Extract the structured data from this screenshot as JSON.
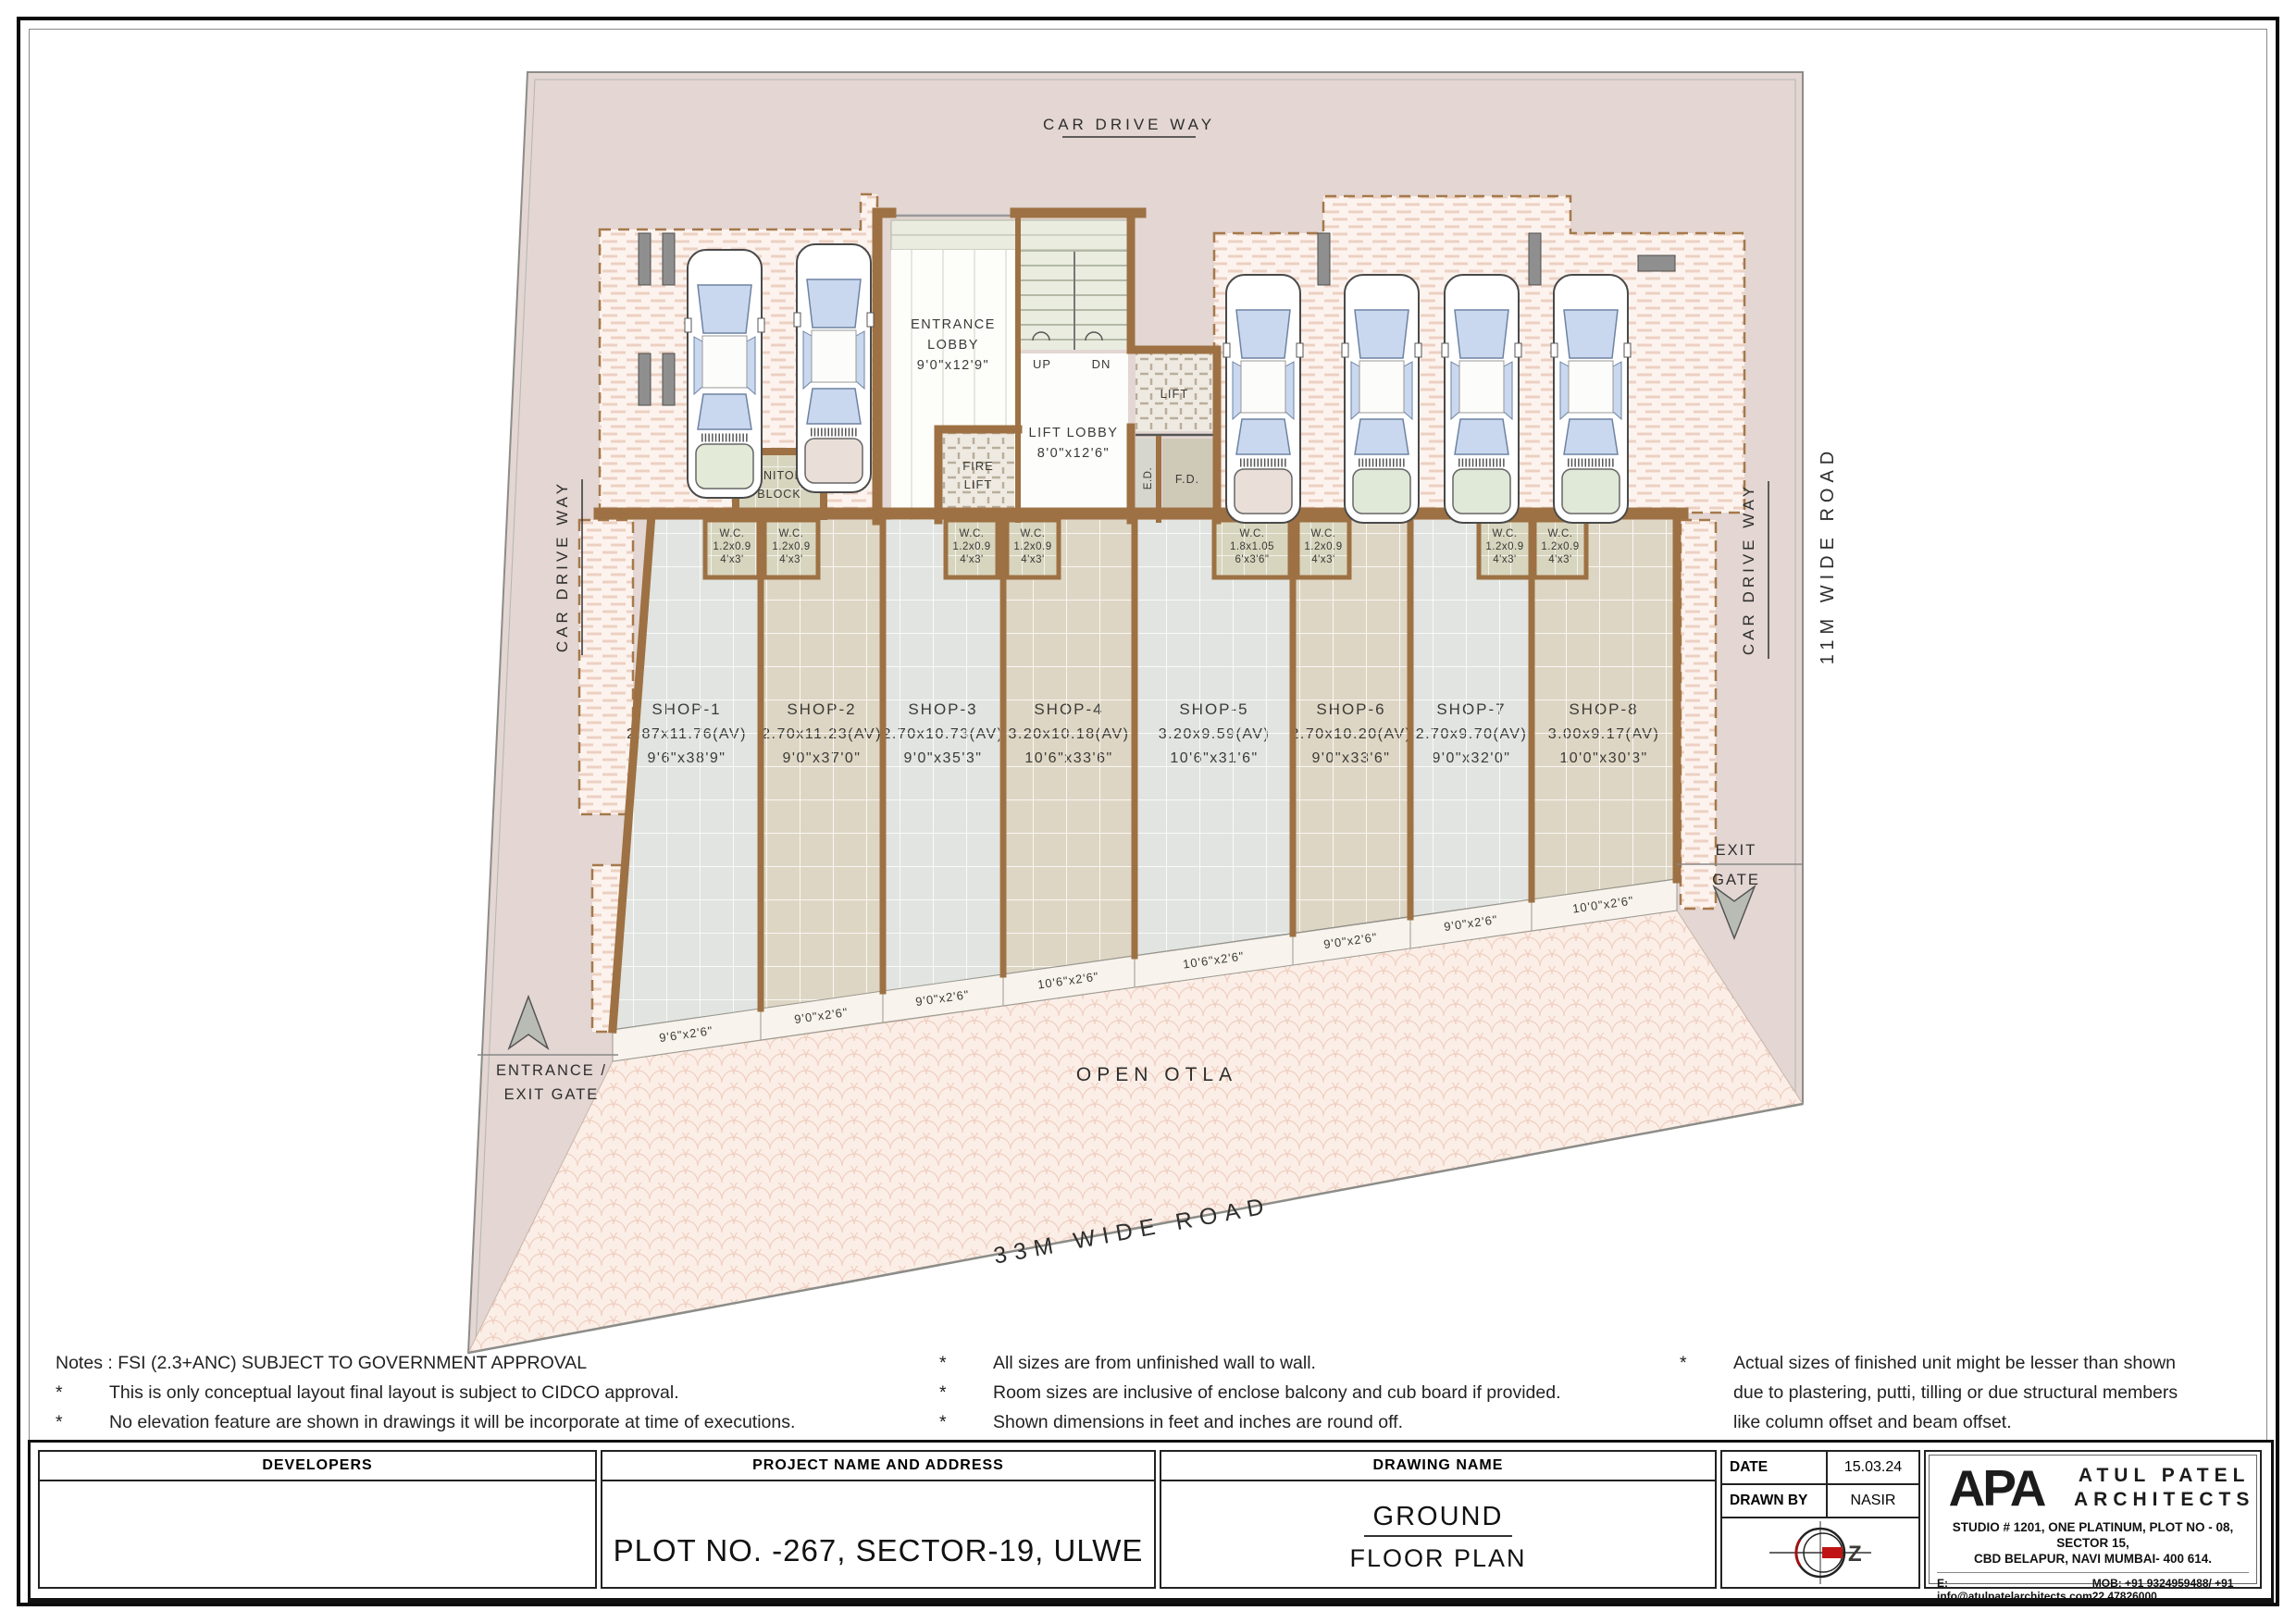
{
  "roads": {
    "top": "CAR DRIVE WAY",
    "left": "CAR DRIVE WAY",
    "right_inner": "CAR DRIVE WAY",
    "right": "11M WIDE ROAD",
    "bottom": "33M WIDE ROAD"
  },
  "areas": {
    "open_otla": "OPEN OTLA"
  },
  "gates": {
    "entrance_line1": "ENTRANCE /",
    "entrance_line2": "EXIT GATE",
    "exit_line1": "EXIT",
    "exit_line2": "GATE"
  },
  "rooms": {
    "entrance_lobby_1": "ENTRANCE",
    "entrance_lobby_2": "LOBBY",
    "entrance_lobby_dim": "9'0\"x12'9\"",
    "lift_lobby": "LIFT LOBBY",
    "lift_lobby_dim": "8'0\"x12'6\"",
    "lift": "LIFT",
    "fire_lift_1": "FIRE",
    "fire_lift_2": "LIFT",
    "sanitory_1": "SANITORY",
    "sanitory_2": "BLOCK",
    "ed": "E.D.",
    "fd": "F.D.",
    "up": "UP",
    "dn": "DN"
  },
  "wcs": [
    {
      "t": "W.C.",
      "m": "1.2x0.9",
      "f": "4'x3'"
    },
    {
      "t": "W.C.",
      "m": "1.2x0.9",
      "f": "4'x3'"
    },
    {
      "t": "W.C.",
      "m": "1.2x0.9",
      "f": "4'x3'"
    },
    {
      "t": "W.C.",
      "m": "1.2x0.9",
      "f": "4'x3'"
    },
    {
      "t": "W.C.",
      "m": "1.8x1.05",
      "f": "6'x3'6\""
    },
    {
      "t": "W.C.",
      "m": "1.2x0.9",
      "f": "4'x3'"
    },
    {
      "t": "W.C.",
      "m": "1.2x0.9",
      "f": "4'x3'"
    },
    {
      "t": "W.C.",
      "m": "1.2x0.9",
      "f": "4'x3'"
    }
  ],
  "shops": [
    {
      "name": "SHOP-1",
      "m": "2.87x11.76(AV)",
      "f": "9'6\"x38'9\""
    },
    {
      "name": "SHOP-2",
      "m": "2.70x11.23(AV)",
      "f": "9'0\"x37'0\""
    },
    {
      "name": "SHOP-3",
      "m": "2.70x10.73(AV)",
      "f": "9'0\"x35'3\""
    },
    {
      "name": "SHOP-4",
      "m": "3.20x10.18(AV)",
      "f": "10'6\"x33'6\""
    },
    {
      "name": "SHOP-5",
      "m": "3.20x9.59(AV)",
      "f": "10'6\"x31'6\""
    },
    {
      "name": "SHOP-6",
      "m": "2.70x10.20(AV)",
      "f": "9'0\"x33'6\""
    },
    {
      "name": "SHOP-7",
      "m": "2.70x9.70(AV)",
      "f": "9'0\"x32'0\""
    },
    {
      "name": "SHOP-8",
      "m": "3.00x9.17(AV)",
      "f": "10'0\"x30'3\""
    }
  ],
  "porches": [
    "9'6\"x2'6\"",
    "9'0\"x2'6\"",
    "9'0\"x2'6\"",
    "10'6\"x2'6\"",
    "10'6\"x2'6\"",
    "9'0\"x2'6\"",
    "9'0\"x2'6\"",
    "10'0\"x2'6\""
  ],
  "notes": {
    "star": "*",
    "c1_title": "Notes : FSI (2.3+ANC) SUBJECT TO GOVERNMENT APPROVAL",
    "c1": [
      "This is only conceptual layout final layout is subject to CIDCO approval.",
      "No elevation feature are shown in drawings it will be incorporate at time of executions."
    ],
    "c2": [
      "All sizes are from unfinished wall to wall.",
      "Room sizes are inclusive of enclose balcony and cub board if provided.",
      "Shown dimensions in feet and inches are round off."
    ],
    "c3_first": "Actual sizes of finished unit might be lesser than shown",
    "c3_rest": [
      "due to plastering, putti, tilling  or due structural members",
      "like column offset and beam offset."
    ]
  },
  "titleblock": {
    "developers_header": "DEVELOPERS",
    "project_header": "PROJECT NAME AND ADDRESS",
    "project_value": "PLOT NO. -267, SECTOR-19, ULWE",
    "drawing_header": "DRAWING NAME",
    "drawing_line1": "GROUND",
    "drawing_line2": "FLOOR PLAN",
    "date_label": "DATE",
    "date_value": "15.03.24",
    "drawnby_label": "DRAWN BY",
    "drawnby_value": "NASIR",
    "compass_letter": "Z",
    "firm_logo": "APA",
    "firm_name1": "ATUL PATEL",
    "firm_name2": "ARCHITECTS",
    "firm_addr1": "STUDIO # 1201, ONE PLATINUM, PLOT NO - 08, SECTOR 15,",
    "firm_addr2": "CBD BELAPUR, NAVI MUMBAI- 400 614.",
    "firm_email": "E: info@atulpatelarchitects.com",
    "firm_mob": "MOB: +91 9324959488/ +91 22 47826000"
  },
  "colors": {
    "plot_fill": "#e3d6d3",
    "wall_brown": "#9d7143",
    "shop_gray": "#e1e4e0",
    "shop_beige": "#ded6c4",
    "hatch_bg": "#fdf3ee",
    "compass_red": "#c01414"
  }
}
